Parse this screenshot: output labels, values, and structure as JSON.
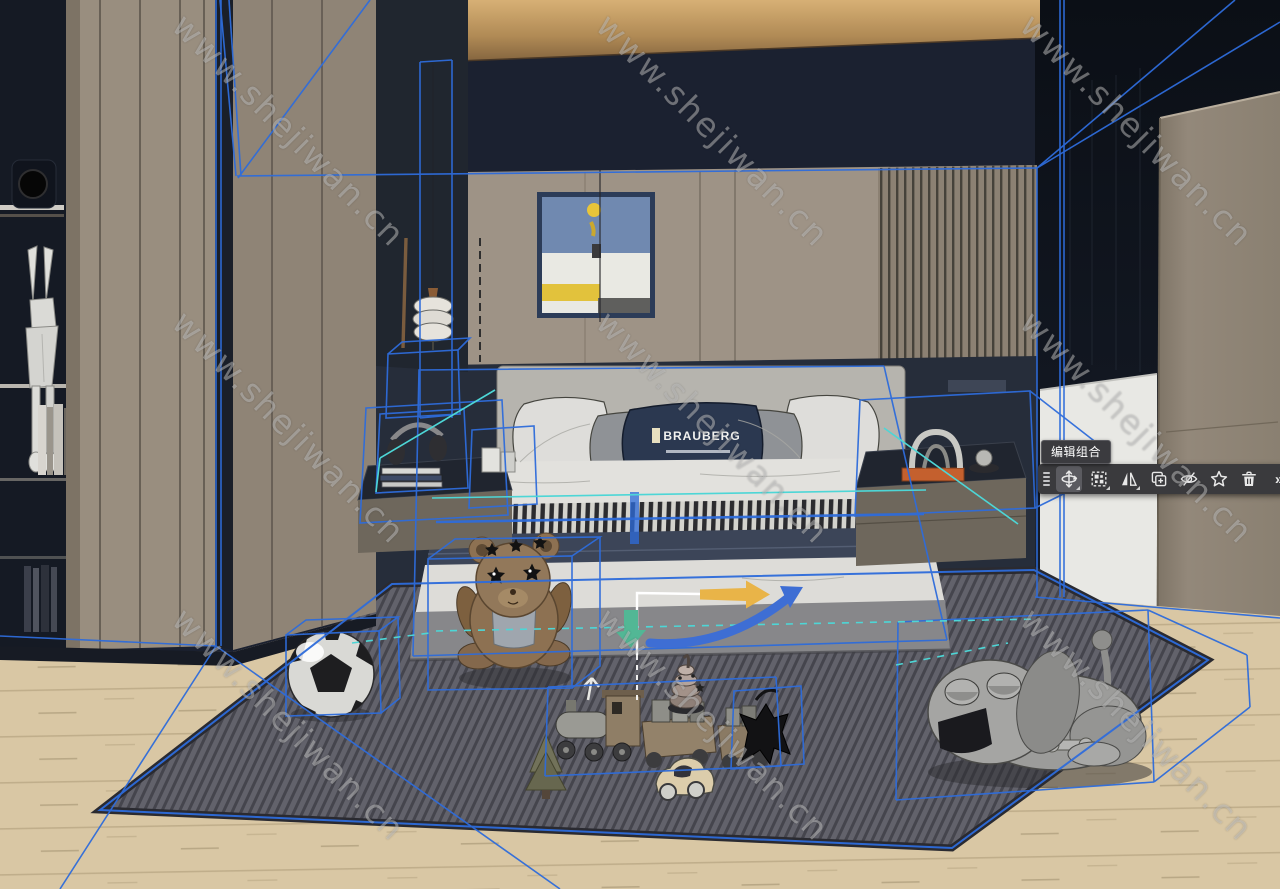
{
  "watermark": {
    "text": "www.shejiwan.cn"
  },
  "toolbar": {
    "tooltip": "编辑组合",
    "more_glyph": "»",
    "buttons": [
      {
        "name": "move",
        "selected": true,
        "has_flyout": true
      },
      {
        "name": "select",
        "selected": false,
        "has_flyout": true
      },
      {
        "name": "flip",
        "selected": false,
        "has_flyout": true
      },
      {
        "name": "copy",
        "selected": false,
        "has_flyout": false
      },
      {
        "name": "hide",
        "selected": false,
        "has_flyout": false
      },
      {
        "name": "favorite",
        "selected": false,
        "has_flyout": false
      },
      {
        "name": "delete",
        "selected": false,
        "has_flyout": false
      },
      {
        "name": "more",
        "selected": false,
        "has_flyout": false
      }
    ]
  },
  "scene": {
    "pillow_brand": "BRAUBERG"
  },
  "colors": {
    "selection_blue": "#2e6cdb",
    "selection_cyan": "#4dd6d6",
    "gizmo_yellow": "#e9b448",
    "gizmo_green": "#52b795",
    "gizmo_arc_blue": "#3e6ed4",
    "toolbar_background": "#3a3a3d",
    "ceiling_navy": "#1b2130",
    "wall_taupe": "#9e9386",
    "floor_wood": "#d9c7a4",
    "carpet_gray": "#61616a"
  }
}
